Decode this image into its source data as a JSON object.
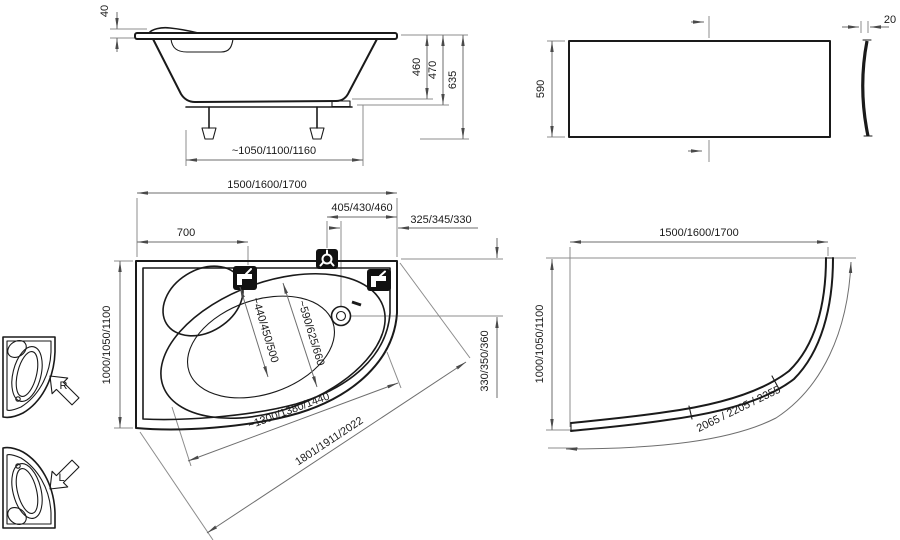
{
  "side_view": {
    "lip_height": "40",
    "depth": "460",
    "frame_height": "470",
    "total_height": "635",
    "feet_span": "~1050/1100/1160"
  },
  "front_panel": {
    "height": "590",
    "thickness": "20"
  },
  "top_view": {
    "length": "1500/1600/1700",
    "mixer_offset": "405/430/460",
    "drain_offset": "325/345/330",
    "tap_offset": "700",
    "width": "1000/1050/1100",
    "basin_width_narrow": "~440/450/500",
    "basin_width_wide": "~590/625/660",
    "basin_length": "~1300/1380/1440",
    "diagonal": "1801/1911/2022",
    "drain_from_edge": "330/350/360"
  },
  "panel_plan": {
    "length": "1500/1600/1700",
    "width": "1000/1050/1100",
    "curve_length": "2065 / 2205 / 2355"
  },
  "variants": {
    "right_label": "R",
    "left_label": "L"
  },
  "icons": {
    "tap": "tap-icon",
    "mixer": "mixer-icon",
    "drain": "drain-icon",
    "overflow": "overflow-mark"
  },
  "colors": {
    "background": "#ffffff",
    "outline": "#1a1a1a",
    "dimension_line": "#8c8c8c",
    "text": "#1a1a1a",
    "icon_fill": "#111111"
  }
}
